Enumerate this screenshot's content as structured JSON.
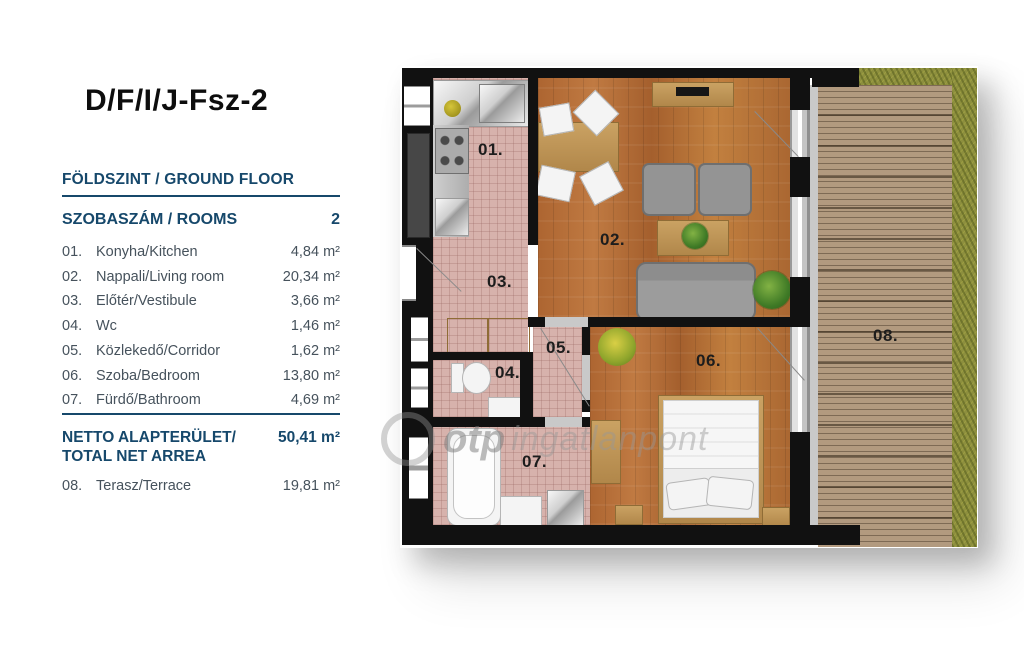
{
  "panel": {
    "title": "D/F/I/J-Fsz-2",
    "floor_label": "FÖLDSZINT / GROUND FLOOR",
    "rooms_header": {
      "label": "SZOBASZÁM / ROOMS",
      "value": "2"
    },
    "rooms": [
      {
        "num": "01.",
        "name": "Konyha/Kitchen",
        "area": "4,84 m²"
      },
      {
        "num": "02.",
        "name": "Nappali/Living room",
        "area": "20,34 m²"
      },
      {
        "num": "03.",
        "name": "Előtér/Vestibule",
        "area": "3,66 m²"
      },
      {
        "num": "04.",
        "name": "Wc",
        "area": "1,46 m²"
      },
      {
        "num": "05.",
        "name": "Közlekedő/Corridor",
        "area": "1,62 m²"
      },
      {
        "num": "06.",
        "name": "Szoba/Bedroom",
        "area": "13,80 m²"
      },
      {
        "num": "07.",
        "name": "Fürdő/Bathroom",
        "area": "4,69 m²"
      }
    ],
    "total": {
      "label_line1": "NETTO ALAPTERÜLET/",
      "label_line2": "TOTAL NET ARREA",
      "value": "50,41 m²"
    },
    "terrace_row": {
      "num": "08.",
      "name": "Terasz/Terrace",
      "area": "19,81 m²"
    }
  },
  "plan": {
    "room_labels": [
      "01.",
      "02.",
      "03.",
      "04.",
      "05.",
      "06.",
      "07.",
      "08."
    ],
    "watermark": {
      "brand": "otp",
      "suffix": "ingatlanpont"
    }
  },
  "colors": {
    "heading_navy": "#16486b",
    "list_text": "#46525c",
    "wall_black": "#111111",
    "tile_pink": "#d7b2ac",
    "wood_floor": "#b5703a",
    "deck_tan": "#b29a7f",
    "grass_green": "#8d8f3e"
  }
}
